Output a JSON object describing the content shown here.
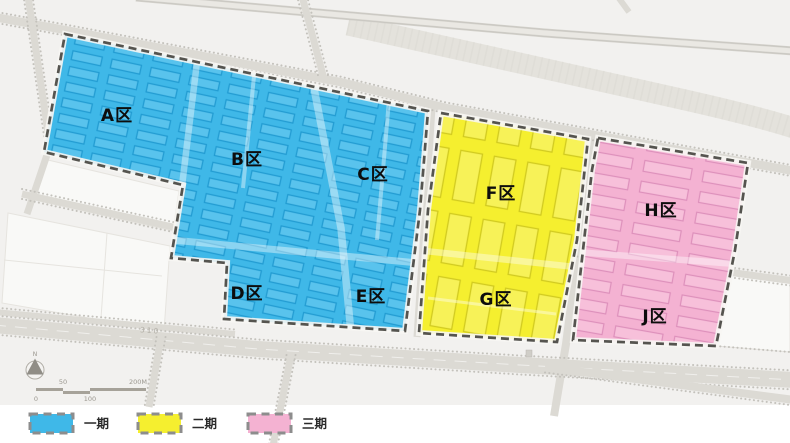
{
  "legend": {
    "items": [
      {
        "label": "一期",
        "color": "#3fb8e8"
      },
      {
        "label": "二期",
        "color": "#f5ef2f"
      },
      {
        "label": "三期",
        "color": "#f4b2d2"
      }
    ]
  },
  "zones": [
    {
      "label": "A区",
      "phase": "一期"
    },
    {
      "label": "B区",
      "phase": "一期"
    },
    {
      "label": "C区",
      "phase": "一期"
    },
    {
      "label": "D区",
      "phase": "一期"
    },
    {
      "label": "E区",
      "phase": "一期"
    },
    {
      "label": "F区",
      "phase": "二期"
    },
    {
      "label": "G区",
      "phase": "二期"
    },
    {
      "label": "H区",
      "phase": "三期"
    },
    {
      "label": "J区",
      "phase": "三期"
    }
  ],
  "map_annotations": {
    "road_label": "310",
    "north_label": "N",
    "scale_bar": {
      "tick_0": "0",
      "tick_50": "50",
      "tick_100": "100",
      "tick_200": "200M"
    }
  }
}
